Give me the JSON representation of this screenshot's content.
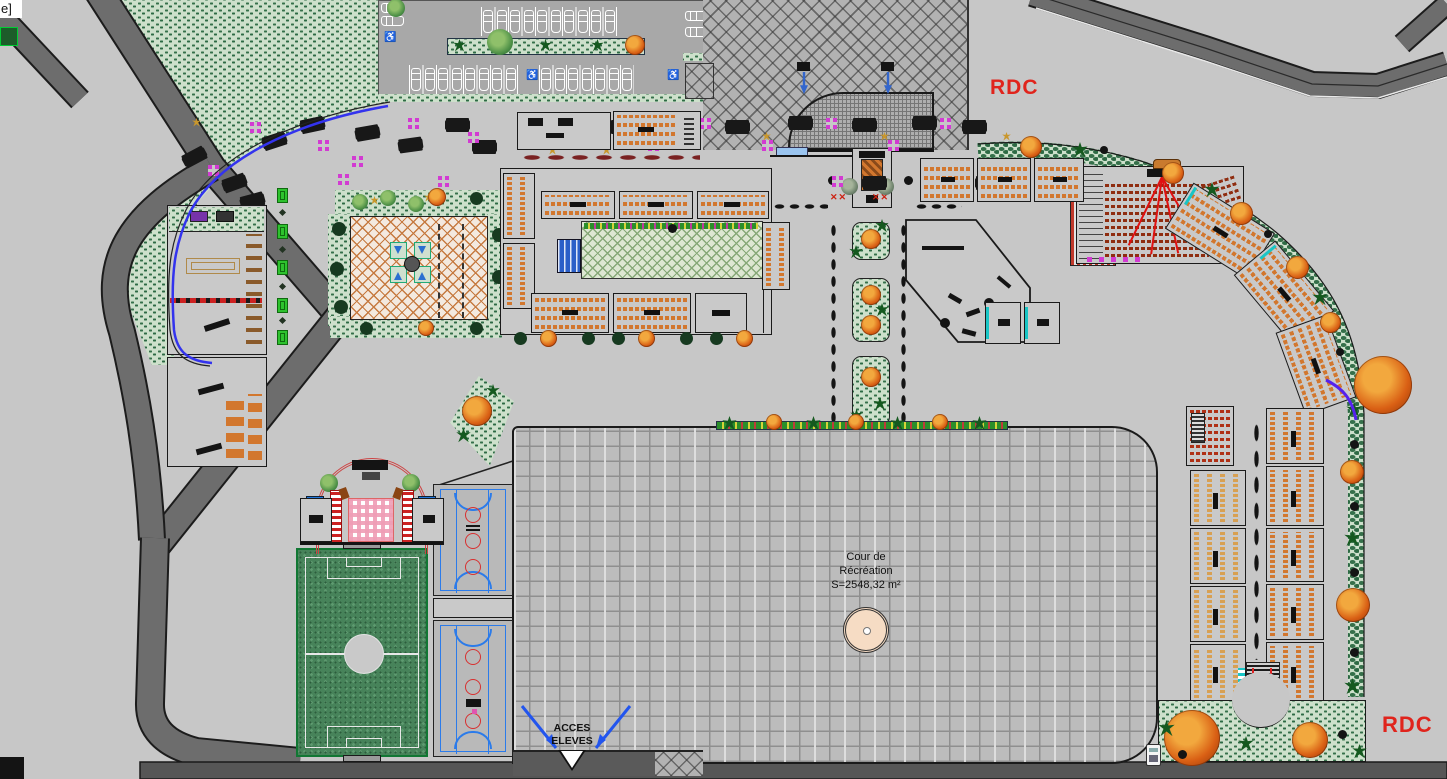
{
  "meta": {
    "drawing_type": "architectural site plan",
    "floor_shown": "RDC"
  },
  "labels": {
    "corner": "e]",
    "rdc_top": "RDC",
    "rdc_bottom": "RDC",
    "courtyard_l1": "Cour de",
    "courtyard_l2": "Récréation",
    "courtyard_l3": "S=2548,32 m²",
    "access_l1": "ACCES",
    "access_l2": "ELEVES",
    "handicap_icon": "♿",
    "red_x": "✕✕"
  },
  "colors": {
    "label_red": "#e0241c",
    "canvas_gray": "#c7c7c7",
    "road_gray": "#6d6d6d",
    "hedge_green": "#35704a",
    "desk_orange": "#d2772e",
    "boundary_blue": "#2d2df0",
    "court_blue": "#2b7bea",
    "court_red": "#d83030",
    "lattice_orange": "#c67a40",
    "stage_pink": "#ef9db5",
    "grass_green": "#47835a"
  },
  "counts": {
    "parking_top_cars": 10,
    "parking_bottom_cars_left": 8,
    "parking_bottom_cars_right": 7,
    "parking_left_cars": 2,
    "parking_right_cars": 2,
    "benches": 5
  }
}
